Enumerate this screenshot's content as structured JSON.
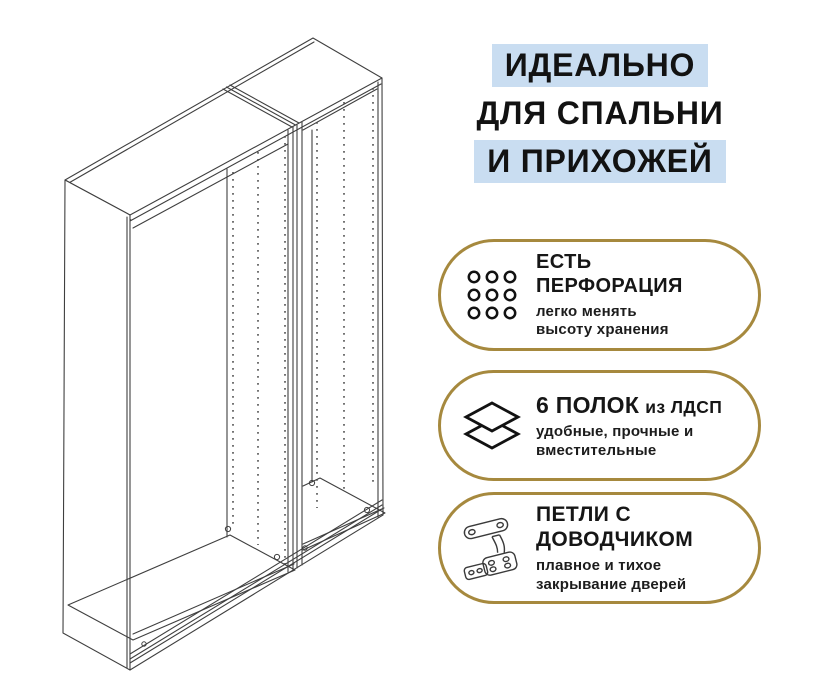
{
  "headline": {
    "line1": "ИДЕАЛЬНО",
    "line2": "ДЛЯ СПАЛЬНИ",
    "line3": "И ПРИХОЖЕЙ",
    "highlight_color": "#c9ddf1"
  },
  "features": [
    {
      "icon": "perforation-grid-icon",
      "title_lines": [
        "ЕСТЬ",
        "ПЕРФОРАЦИЯ"
      ],
      "subtitle_lines": [
        "легко менять",
        "высоту хранения"
      ]
    },
    {
      "icon": "shelves-layers-icon",
      "title_main": "6 ПОЛОК",
      "title_suffix": "из ЛДСП",
      "subtitle_lines": [
        "удобные, прочные и",
        "вместительные"
      ]
    },
    {
      "icon": "hinge-icon",
      "title_lines": [
        "ПЕТЛИ С",
        "ДОВОДЧИКОМ"
      ],
      "subtitle_lines": [
        "плавное и тихое",
        "закрывание дверей"
      ]
    }
  ],
  "illustration": {
    "name": "two-section-wardrobe-frame-line-drawing"
  },
  "colors": {
    "background": "#ffffff",
    "highlight_blue": "#c9ddf1",
    "badge_border_gold": "#a6893e",
    "text": "#161616",
    "line_art": "#3f3f3f"
  }
}
